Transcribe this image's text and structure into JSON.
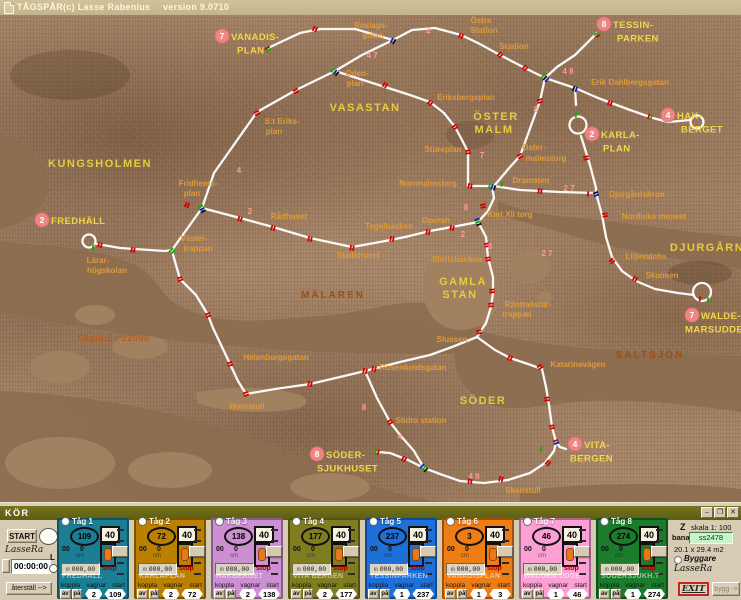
{
  "titlebar": {
    "app": "TÅGSPÅR",
    "copyright": "(c) Lasse Rabenius",
    "version": "version 9.0710"
  },
  "panel": {
    "title": "KÖR",
    "start": "START",
    "signature": "LasseRa",
    "clock": "00:00:00",
    "l": "L",
    "reset": "återställ -->",
    "winbtns": [
      "–",
      "❐",
      "✕"
    ],
    "labels": {
      "koppla": "koppla",
      "vagnar": "vagnar",
      "start": "start",
      "av": "av",
      "pa": "på",
      "stop": "stop",
      "cm": "cm",
      "m": "m",
      "m_value": "000,00",
      "odo_left": "00",
      "odo_right": "0"
    },
    "trains": [
      {
        "name": "Tåg 1",
        "id": "109",
        "speed": "40",
        "station": "FREDHALL",
        "vagnar": "2",
        "start": "109",
        "color": "#1b7e93"
      },
      {
        "name": "Tåg 2",
        "id": "72",
        "speed": "40",
        "station": "KARLAPLAN",
        "vagnar": "2",
        "start": "72",
        "color": "#bb8000"
      },
      {
        "name": "Tåg 3",
        "id": "138",
        "speed": "40",
        "station": "HAKBERGET",
        "vagnar": "2",
        "start": "138",
        "color": "#cc8fd2"
      },
      {
        "name": "Tåg 4",
        "id": "177",
        "speed": "40",
        "station": "VITA BERGEN",
        "vagnar": "2",
        "start": "177",
        "color": "#7f7d20"
      },
      {
        "name": "Tåg 5",
        "id": "237",
        "speed": "40",
        "station": "TESSINPARKEN",
        "vagnar": "1",
        "start": "237",
        "color": "#1e6fd8"
      },
      {
        "name": "Tåg 6",
        "id": "3",
        "speed": "40",
        "station": "VANADISPLAN",
        "vagnar": "1",
        "start": "3",
        "color": "#ee7d16"
      },
      {
        "name": "Tåg 7",
        "id": "46",
        "speed": "40",
        "station": "WALDEM.UDDE",
        "vagnar": "1",
        "start": "46",
        "color": "#fb9fd4"
      },
      {
        "name": "Tåg 8",
        "id": "274",
        "speed": "40",
        "station": "SÖDERSJUKH.T",
        "vagnar": "1",
        "start": "274",
        "color": "#1b7c2c"
      }
    ]
  },
  "info": {
    "z": "Z",
    "skala": "skala 1: 100",
    "bana": "bana",
    "bana_value": "ss2478",
    "dims": "20.1 x 29.4 m2",
    "byggare": "Byggare",
    "signature": "LasseRa",
    "exit": "EXIT",
    "bygg": "bygg ->"
  },
  "map": {
    "scale": {
      "t": "Skala 1 : 22000",
      "x": 78,
      "y": 326
    },
    "areas": [
      {
        "t": "KUNGSHOLMEN",
        "x": 100,
        "y": 152
      },
      {
        "t": "VASASTAN",
        "x": 365,
        "y": 96
      },
      {
        "t": "ÖSTER",
        "x": 496,
        "y": 105
      },
      {
        "t": "MALM",
        "x": 494,
        "y": 118
      },
      {
        "t": "GAMLA",
        "x": 463,
        "y": 270
      },
      {
        "t": "STAN",
        "x": 460,
        "y": 283
      },
      {
        "t": "SÖDER",
        "x": 483,
        "y": 389
      },
      {
        "t": "DJURGÅRN",
        "x": 707,
        "y": 236
      }
    ],
    "waters": [
      {
        "t": "MÄLAREN",
        "x": 333,
        "y": 283
      },
      {
        "t": "SALTSJÖN",
        "x": 650,
        "y": 343
      }
    ],
    "stations": [
      {
        "t": "Roslags-",
        "x": 371,
        "y": 13
      },
      {
        "t": "gatan",
        "x": 373,
        "y": 23
      },
      {
        "t": "Östra",
        "x": 481,
        "y": 8
      },
      {
        "t": "Station",
        "x": 484,
        "y": 18
      },
      {
        "t": "Stadion",
        "x": 514,
        "y": 34
      },
      {
        "t": "Erik Dahlbergsgatan",
        "x": 630,
        "y": 70
      },
      {
        "t": "Eriksbergsplan",
        "x": 466,
        "y": 85
      },
      {
        "t": "Oden-",
        "x": 357,
        "y": 61
      },
      {
        "t": "plan",
        "x": 355,
        "y": 71
      },
      {
        "t": "S:t Eriks-",
        "x": 282,
        "y": 109
      },
      {
        "t": "plan",
        "x": 274,
        "y": 119
      },
      {
        "t": "Fridhems-",
        "x": 198,
        "y": 171
      },
      {
        "t": "plan",
        "x": 192,
        "y": 181
      },
      {
        "t": "Stureplan",
        "x": 443,
        "y": 137
      },
      {
        "t": "Öster-",
        "x": 534,
        "y": 135
      },
      {
        "t": "malmstorg",
        "x": 546,
        "y": 146
      },
      {
        "t": "Norrmalmstorg",
        "x": 428,
        "y": 171
      },
      {
        "t": "Dramaten",
        "x": 531,
        "y": 168
      },
      {
        "t": "Karl XII torg",
        "x": 510,
        "y": 202
      },
      {
        "t": "Operan",
        "x": 436,
        "y": 208
      },
      {
        "t": "Rådhuset",
        "x": 289,
        "y": 204
      },
      {
        "t": "Tegelbacken",
        "x": 389,
        "y": 214
      },
      {
        "t": "Stadshuset",
        "x": 358,
        "y": 243
      },
      {
        "t": "Slottsbacken",
        "x": 457,
        "y": 247
      },
      {
        "t": "Räntmästar-",
        "x": 528,
        "y": 292
      },
      {
        "t": "trappan",
        "x": 517,
        "y": 302
      },
      {
        "t": "Slussen",
        "x": 452,
        "y": 327
      },
      {
        "t": "Djurgårdsbron",
        "x": 637,
        "y": 182
      },
      {
        "t": "Nordiska museet",
        "x": 654,
        "y": 204
      },
      {
        "t": "Liljevalchs",
        "x": 646,
        "y": 244
      },
      {
        "t": "Skansen",
        "x": 662,
        "y": 263
      },
      {
        "t": "Katarinavägen",
        "x": 578,
        "y": 352
      },
      {
        "t": "Helenborgsgatan",
        "x": 276,
        "y": 345
      },
      {
        "t": "Rosenlundsgatan",
        "x": 413,
        "y": 355
      },
      {
        "t": "Hornstull",
        "x": 247,
        "y": 394
      },
      {
        "t": "Södra station",
        "x": 421,
        "y": 408
      },
      {
        "t": "Skanstull",
        "x": 523,
        "y": 478
      },
      {
        "t": "Lärar-",
        "x": 98,
        "y": 248
      },
      {
        "t": "högskolan",
        "x": 107,
        "y": 258
      },
      {
        "t": "Väster-",
        "x": 194,
        "y": 226
      },
      {
        "t": "trappan",
        "x": 198,
        "y": 236
      }
    ],
    "termini": [
      {
        "num": "7",
        "cx": 222,
        "cy": 21,
        "tx": 231,
        "ty": 25,
        "ind": 6,
        "lines": [
          "VANADIS-",
          "PLAN"
        ]
      },
      {
        "num": "8",
        "cx": 604,
        "cy": 9,
        "tx": 613,
        "ty": 13,
        "ind": 4,
        "lines": [
          "TESSIN-",
          "PARKEN"
        ]
      },
      {
        "num": "4",
        "cx": 668,
        "cy": 100,
        "tx": 677,
        "ty": 104,
        "ind": 4,
        "lines": [
          "HAK-",
          "BERGET"
        ]
      },
      {
        "num": "2",
        "cx": 592,
        "cy": 119,
        "tx": 601,
        "ty": 123,
        "ind": 2,
        "lines": [
          "KARLA-",
          "PLAN"
        ]
      },
      {
        "num": "2",
        "cx": 42,
        "cy": 205,
        "tx": 51,
        "ty": 209,
        "ind": 0,
        "lines": [
          "FREDHÄLL"
        ]
      },
      {
        "num": "7",
        "cx": 692,
        "cy": 300,
        "tx": 701,
        "ty": 304,
        "ind": -16,
        "lines": [
          "WALDE-",
          "MARSUDDE"
        ]
      },
      {
        "num": "4",
        "cx": 575,
        "cy": 429,
        "tx": 584,
        "ty": 433,
        "ind": -14,
        "lines": [
          "VITA-",
          "BERGEN"
        ]
      },
      {
        "num": "8",
        "cx": 317,
        "cy": 439,
        "tx": 326,
        "ty": 443,
        "ind": -9,
        "lines": [
          "SÖDER-",
          "SJUKHUSET"
        ]
      }
    ],
    "route_numbers": [
      {
        "t": "4",
        "x": 428,
        "y": 19
      },
      {
        "t": "4 7",
        "x": 372,
        "y": 43
      },
      {
        "t": "4",
        "x": 239,
        "y": 158
      },
      {
        "t": "2",
        "x": 250,
        "y": 199
      },
      {
        "t": "4 8",
        "x": 568,
        "y": 59
      },
      {
        "t": "8",
        "x": 536,
        "y": 97
      },
      {
        "t": "7",
        "x": 482,
        "y": 143
      },
      {
        "t": "2 7",
        "x": 569,
        "y": 176
      },
      {
        "t": "8",
        "x": 466,
        "y": 195
      },
      {
        "t": "2",
        "x": 463,
        "y": 222
      },
      {
        "t": "8",
        "x": 490,
        "y": 234
      },
      {
        "t": "2 7",
        "x": 547,
        "y": 241
      },
      {
        "t": "4",
        "x": 400,
        "y": 424
      },
      {
        "t": "4 8",
        "x": 474,
        "y": 464
      },
      {
        "t": "8",
        "x": 364,
        "y": 395
      }
    ]
  }
}
